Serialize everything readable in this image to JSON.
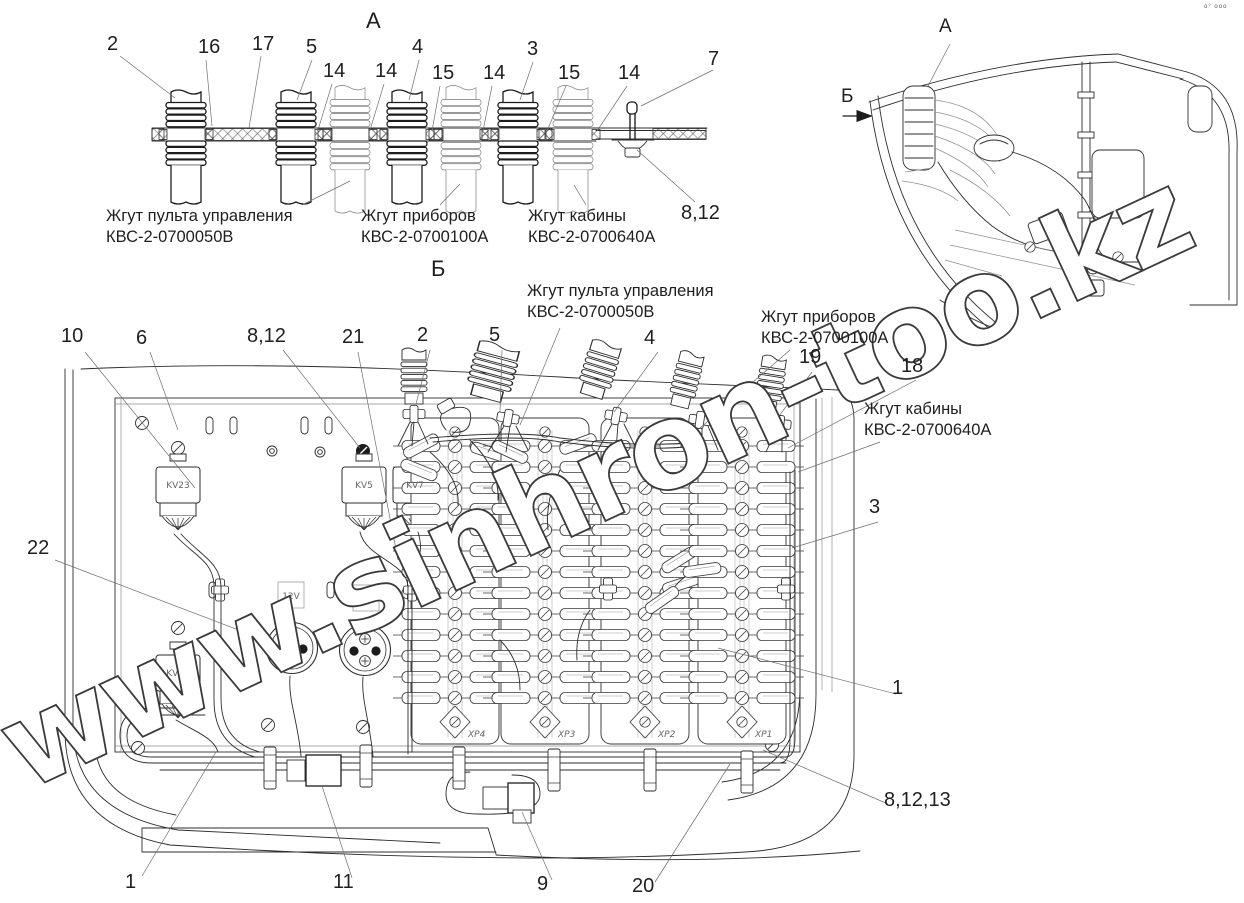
{
  "titles": {
    "view_a": "А",
    "view_b": "Б"
  },
  "inset": {
    "label_a": "А",
    "label_b": "Б"
  },
  "harnesses": {
    "pult": {
      "name": "Жгут пульта управления",
      "code": "КВС-2-0700050В"
    },
    "pribor": {
      "name": "Жгут приборов",
      "code": "КВС-2-0700100А"
    },
    "kabina": {
      "name": "Жгут кабины",
      "code": "КВС-2-0700640А"
    }
  },
  "view_a": {
    "callouts": [
      "2",
      "16",
      "17",
      "5",
      "14",
      "14",
      "4",
      "15",
      "14",
      "3",
      "15",
      "14",
      "7",
      "8,12"
    ]
  },
  "view_b": {
    "top_callouts": [
      "10",
      "6",
      "8,12",
      "21",
      "2",
      "5",
      "4",
      "19",
      "18"
    ],
    "left_callout": "22",
    "right_callouts": [
      "3",
      "1",
      "8,12,13"
    ],
    "bottom_callouts": [
      "1",
      "11",
      "9",
      "20"
    ],
    "relays": {
      "kv23": "KV23",
      "kv5": "KV5",
      "kv7": "KV7",
      "kv24": "KV24"
    },
    "voltage_labels": [
      "12V",
      "24V"
    ],
    "strip_labels": [
      "XP4",
      "XP3",
      "XP2",
      "XP1"
    ]
  },
  "watermark": "www.sinhron-too.kz",
  "corner_mark": "о° ооо"
}
